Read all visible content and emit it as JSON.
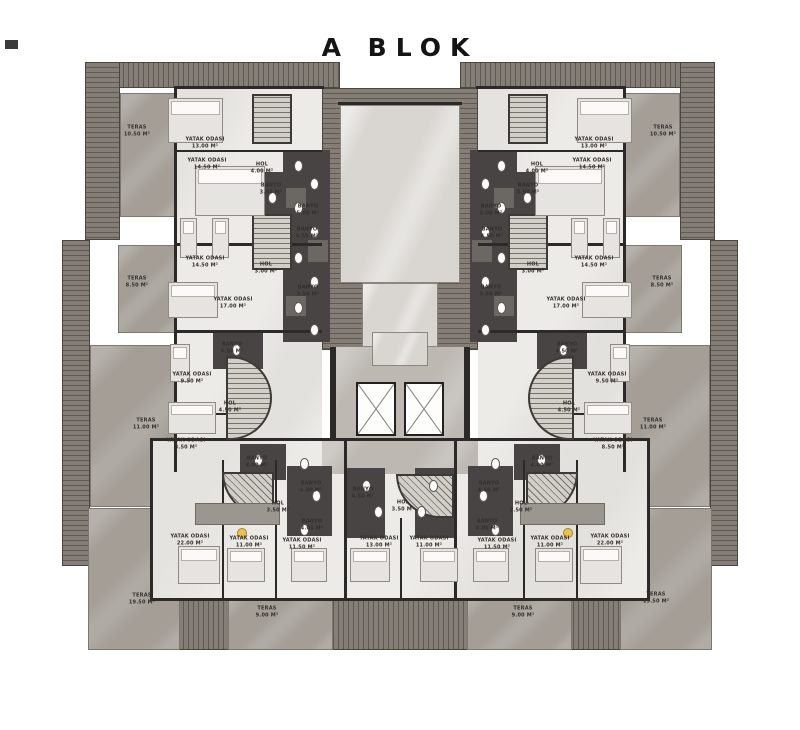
{
  "title": "A BLOK",
  "colors": {
    "roof": "#847e77",
    "roofLine": "#5e5952",
    "marble": "#a49e97",
    "marbleLight": "#d9d6d1",
    "floor": "#edebe7",
    "bath": "#474443",
    "wall": "#2b2a28",
    "lobby": "#bdb8b2",
    "lamp": "#e9c24b"
  },
  "plan": {
    "rooms": [
      {
        "name": "TERAS",
        "area": "10.50 M²",
        "x": 137,
        "y": 131
      },
      {
        "name": "YATAK ODASI",
        "area": "13.00 M²",
        "x": 205,
        "y": 143
      },
      {
        "name": "YATAK ODASI",
        "area": "14.50 M²",
        "x": 207,
        "y": 164
      },
      {
        "name": "HOL",
        "area": "4.00 M²",
        "x": 262,
        "y": 168
      },
      {
        "name": "BANYO",
        "area": "3.50 M²",
        "x": 271,
        "y": 189
      },
      {
        "name": "BANYO",
        "area": "5.00 M²",
        "x": 308,
        "y": 210
      },
      {
        "name": "BANYO",
        "area": "4.50 M²",
        "x": 307,
        "y": 233
      },
      {
        "name": "YATAK ODASI",
        "area": "14.50 M²",
        "x": 205,
        "y": 262
      },
      {
        "name": "HOL",
        "area": "3.00 M²",
        "x": 266,
        "y": 268
      },
      {
        "name": "TERAS",
        "area": "8.50 M²",
        "x": 137,
        "y": 282
      },
      {
        "name": "BANYO",
        "area": "3.50 M²",
        "x": 308,
        "y": 291
      },
      {
        "name": "YATAK ODASI",
        "area": "17.00 M²",
        "x": 233,
        "y": 303
      },
      {
        "name": "BANYO",
        "area": "4.50 M²",
        "x": 232,
        "y": 348
      },
      {
        "name": "YATAK ODASI",
        "area": "9.50 M²",
        "x": 192,
        "y": 378
      },
      {
        "name": "HOL",
        "area": "4.50 M²",
        "x": 230,
        "y": 407
      },
      {
        "name": "TERAS",
        "area": "11.00 M²",
        "x": 146,
        "y": 424
      },
      {
        "name": "YATAK ODASI",
        "area": "8.50 M²",
        "x": 186,
        "y": 444
      },
      {
        "name": "BANYO",
        "area": "4.00 M²",
        "x": 257,
        "y": 462
      },
      {
        "name": "BANYO",
        "area": "4.50 M²",
        "x": 311,
        "y": 487
      },
      {
        "name": "HOL",
        "area": "3.50 M²",
        "x": 278,
        "y": 507
      },
      {
        "name": "BANYO",
        "area": "4.00 M²",
        "x": 312,
        "y": 525
      },
      {
        "name": "YATAK ODASI",
        "area": "22.00 M²",
        "x": 190,
        "y": 540
      },
      {
        "name": "YATAK ODASI",
        "area": "11.00 M²",
        "x": 249,
        "y": 542
      },
      {
        "name": "YATAK ODASI",
        "area": "11.50 M²",
        "x": 302,
        "y": 544
      },
      {
        "name": "TERAS",
        "area": "19.50 M²",
        "x": 142,
        "y": 599
      },
      {
        "name": "TERAS",
        "area": "9.00 M²",
        "x": 267,
        "y": 612
      },
      {
        "name": "BANYO",
        "area": "4.50 M²",
        "x": 363,
        "y": 493
      },
      {
        "name": "YATAK ODASI",
        "area": "13.00 M²",
        "x": 379,
        "y": 542
      },
      {
        "name": "HOL",
        "area": "3.50 M²",
        "x": 403,
        "y": 506
      },
      {
        "name": "YATAK ODASI",
        "area": "11.00 M²",
        "x": 429,
        "y": 542
      },
      {
        "name": "TERAS",
        "area": "9.00 M²",
        "x": 523,
        "y": 612
      },
      {
        "name": "YATAK ODASI",
        "area": "11.50 M²",
        "x": 497,
        "y": 544
      },
      {
        "name": "YATAK ODASI",
        "area": "11.00 M²",
        "x": 550,
        "y": 542
      },
      {
        "name": "YATAK ODASI",
        "area": "22.00 M²",
        "x": 610,
        "y": 540
      },
      {
        "name": "TERAS",
        "area": "19.50 M²",
        "x": 656,
        "y": 598
      },
      {
        "name": "BANYO",
        "area": "4.00 M²",
        "x": 487,
        "y": 525
      },
      {
        "name": "HOL",
        "area": "3.50 M²",
        "x": 521,
        "y": 507
      },
      {
        "name": "BANYO",
        "area": "4.50 M²",
        "x": 489,
        "y": 487
      },
      {
        "name": "BANYO",
        "area": "4.00 M²",
        "x": 542,
        "y": 462
      },
      {
        "name": "YATAK ODASI",
        "area": "8.50 M²",
        "x": 613,
        "y": 444
      },
      {
        "name": "TERAS",
        "area": "11.00 M²",
        "x": 653,
        "y": 424
      },
      {
        "name": "HOL",
        "area": "4.50 M²",
        "x": 569,
        "y": 407
      },
      {
        "name": "YATAK ODASI",
        "area": "9.50 M²",
        "x": 607,
        "y": 378
      },
      {
        "name": "BANYO",
        "area": "4.50 M²",
        "x": 567,
        "y": 348
      },
      {
        "name": "YATAK ODASI",
        "area": "17.00 M²",
        "x": 566,
        "y": 303
      },
      {
        "name": "BANYO",
        "area": "3.50 M²",
        "x": 491,
        "y": 291
      },
      {
        "name": "TERAS",
        "area": "8.50 M²",
        "x": 662,
        "y": 282
      },
      {
        "name": "HOL",
        "area": "3.00 M²",
        "x": 533,
        "y": 268
      },
      {
        "name": "YATAK ODASI",
        "area": "14.50 M²",
        "x": 594,
        "y": 262
      },
      {
        "name": "BANYO",
        "area": "4.50 M²",
        "x": 492,
        "y": 233
      },
      {
        "name": "BANYO",
        "area": "5.00 M²",
        "x": 491,
        "y": 210
      },
      {
        "name": "BANYO",
        "area": "3.50 M²",
        "x": 528,
        "y": 189
      },
      {
        "name": "HOL",
        "area": "4.00 M²",
        "x": 537,
        "y": 168
      },
      {
        "name": "YATAK ODASI",
        "area": "14.50 M²",
        "x": 592,
        "y": 164
      },
      {
        "name": "YATAK ODASI",
        "area": "13.00 M²",
        "x": 594,
        "y": 143
      },
      {
        "name": "TERAS",
        "area": "10.50 M²",
        "x": 663,
        "y": 131
      }
    ]
  }
}
